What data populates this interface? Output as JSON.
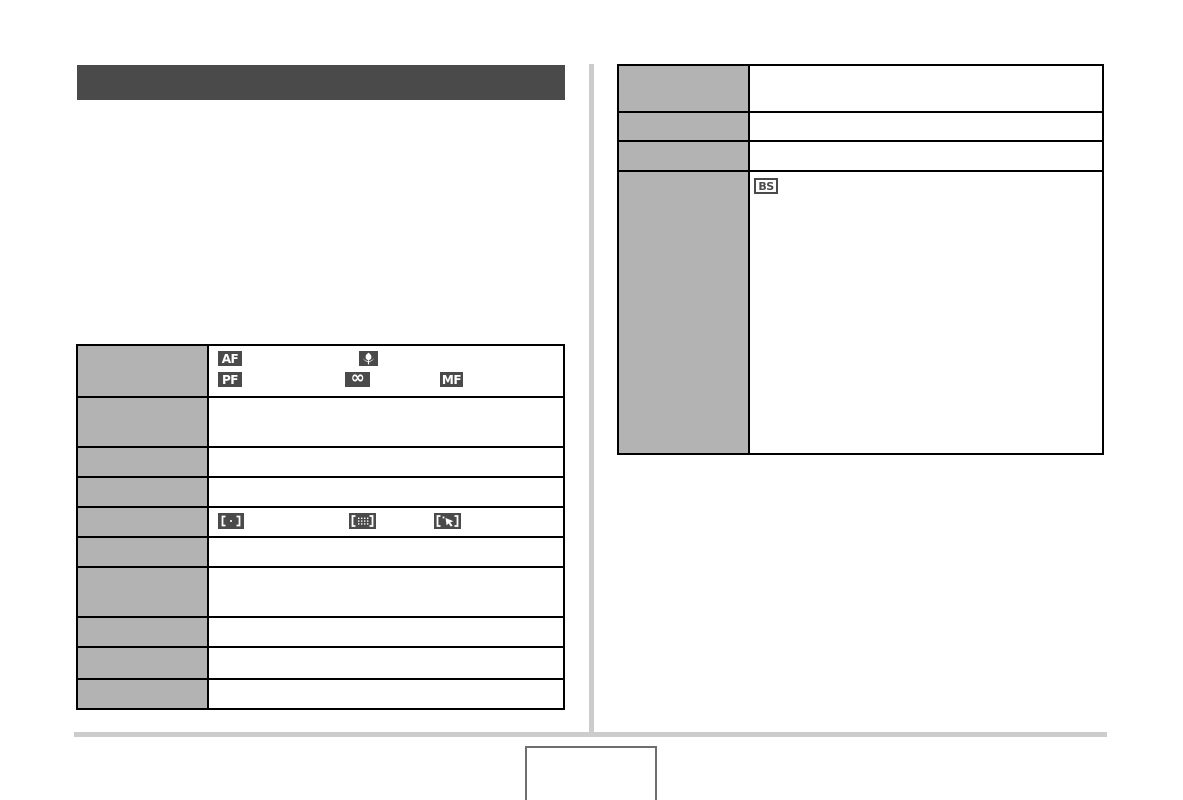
{
  "page": {
    "kind": "scanned camera manual page",
    "colors": {
      "title_bar": "#4a4a4a",
      "table_label_cell": "#b3b3b3",
      "table_border": "#000000",
      "icon_dark_bg": "#4a4a4a",
      "icon_glyph": "#ffffff",
      "column_divider": "#cccccc",
      "footer_rule": "#cccccc",
      "page_box_border": "#6e6e6e"
    }
  },
  "icons": {
    "autofocus": "AF",
    "pan_focus": "PF",
    "manual_focus": "MF",
    "infinity_focus": "∞",
    "macro": "macro-flower-icon",
    "af_area_spot": "af-area-spot-icon",
    "af_area_multi": "af-area-multi-icon",
    "af_area_tracking": "af-area-tracking-icon",
    "best_shot": "BS"
  },
  "left_section": {
    "table": {
      "row_count": 10,
      "rows": [
        {
          "id": "focus-modes",
          "content_icons": [
            "AF",
            "macro",
            "PF",
            "infinity",
            "MF"
          ]
        },
        {
          "id": "row-2",
          "content_icons": []
        },
        {
          "id": "row-3",
          "content_icons": []
        },
        {
          "id": "row-4",
          "content_icons": []
        },
        {
          "id": "af-area",
          "content_icons": [
            "spot",
            "multi",
            "tracking"
          ]
        },
        {
          "id": "row-6",
          "content_icons": []
        },
        {
          "id": "row-7",
          "content_icons": []
        },
        {
          "id": "row-8",
          "content_icons": []
        },
        {
          "id": "row-9",
          "content_icons": []
        },
        {
          "id": "row-10",
          "content_icons": []
        }
      ]
    }
  },
  "right_section": {
    "table": {
      "row_count": 4,
      "rows": [
        {
          "id": "row-1",
          "content_icons": []
        },
        {
          "id": "row-2",
          "content_icons": []
        },
        {
          "id": "row-3",
          "content_icons": []
        },
        {
          "id": "best-shot-row",
          "content_icons": [
            "best_shot"
          ]
        }
      ]
    }
  }
}
